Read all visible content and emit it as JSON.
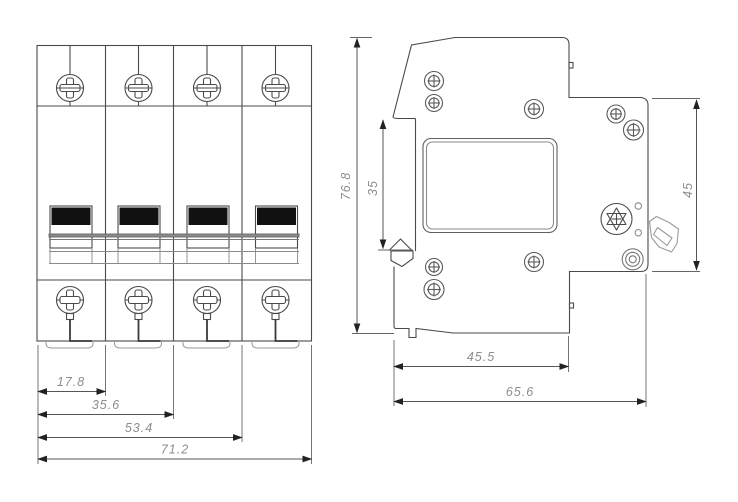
{
  "drawing": {
    "title": "circuit-breaker-dimension-drawing",
    "front_view": {
      "dim_pitch_1": "17.8",
      "dim_pitch_2": "35.6",
      "dim_pitch_3": "53.4",
      "dim_total_width": "71.2"
    },
    "side_view": {
      "dim_total_height": "76.8",
      "dim_rail_recess": "35",
      "dim_right_height": "45",
      "dim_depth_to_step": "45.5",
      "dim_total_depth": "65.6"
    },
    "colors": {
      "line": "#4a4a4a",
      "dim_line": "#555555",
      "arrow": "#222222",
      "dim_text": "#8d8d8d",
      "handle_fill": "#111111",
      "background": "#ffffff"
    }
  }
}
